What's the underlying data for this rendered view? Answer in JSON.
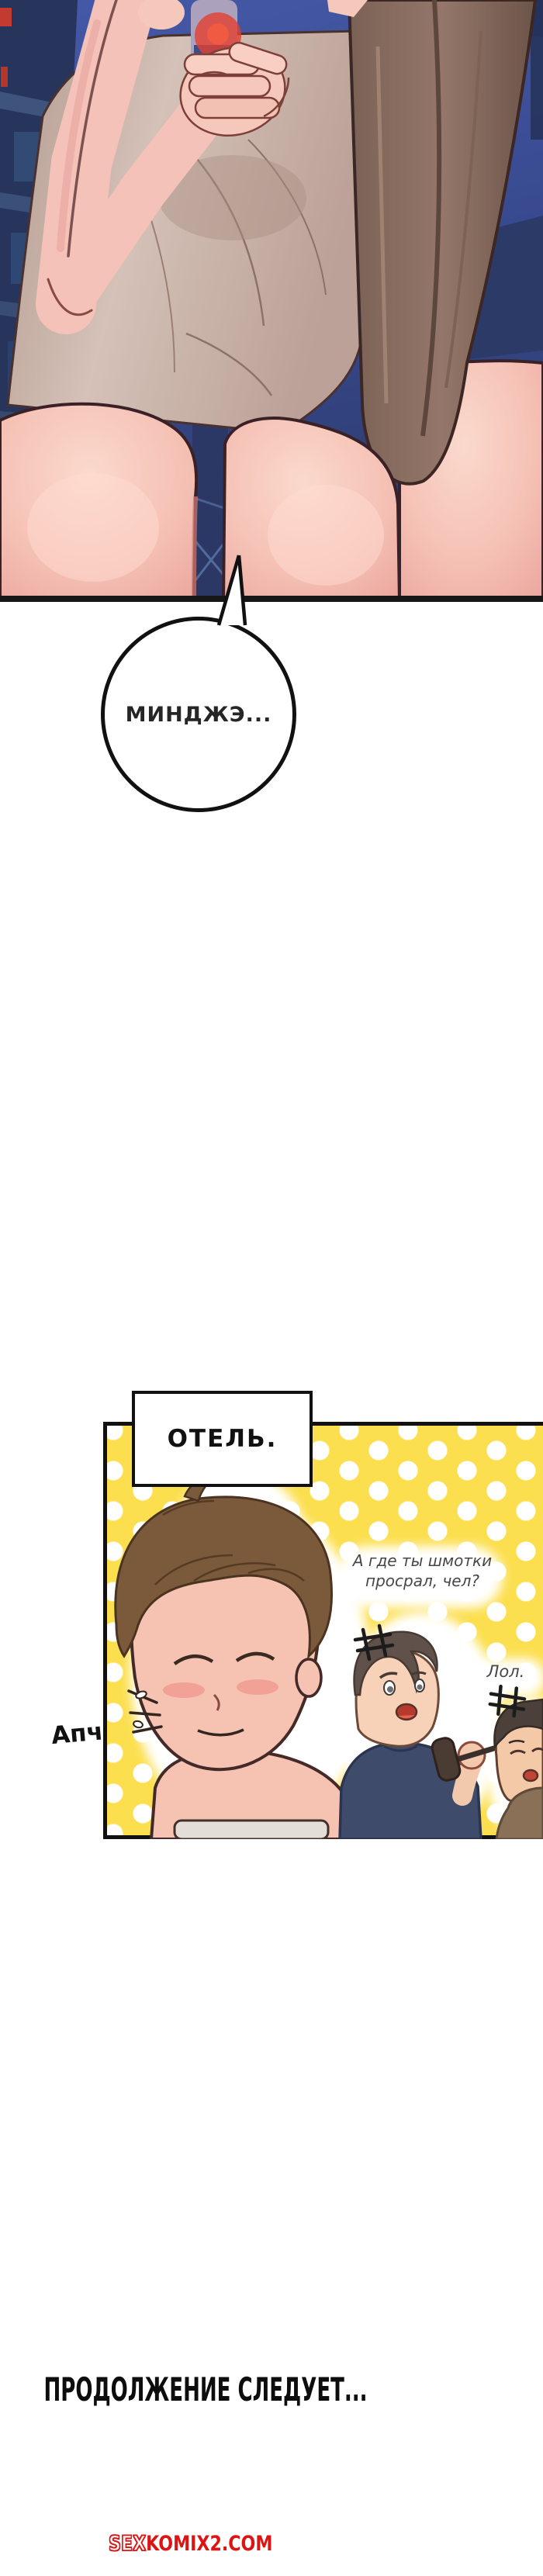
{
  "bubble": {
    "text": "МИНДЖЭ..."
  },
  "panel": {
    "label": "ОТЕЛЬ.",
    "dialogue": {
      "line1": "А где ты шмотки",
      "line2": "просрал, чел?"
    },
    "reply": "Лол.",
    "sfx_sneeze": "Апчхи!"
  },
  "footer": {
    "to_be_continued": "ПРОДОЛЖЕНИЕ СЛЕДУЕТ..."
  },
  "watermark": {
    "prefix": "SEX",
    "suffix": "KOMIX2.COM"
  },
  "colors": {
    "panel_yellow": "#fcdf4e",
    "panel_dot": "#ffffff",
    "watermark_red": "#de1313",
    "night_sky_blue": "#3f55a4",
    "building_navy": "#27345c",
    "skin": "#f5c3b8",
    "dress_taupe": "#c9b5ab",
    "drape_brown": "#8f7366",
    "ink_outline": "#111111"
  }
}
